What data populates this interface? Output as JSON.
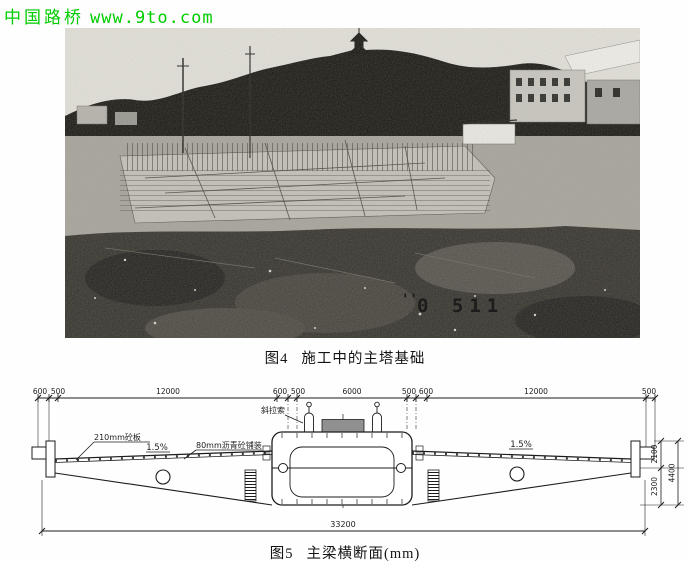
{
  "header": {
    "site_name": "中国路桥",
    "url": "www.9to.com",
    "color": "#00cc00"
  },
  "photo": {
    "description": "construction-site-photo",
    "stamp_marks": "''",
    "stamp": "0 511"
  },
  "figure4": {
    "label": "图4",
    "title": "施工中的主塔基础"
  },
  "figure5": {
    "label": "图5",
    "title": "主梁横断面(mm)",
    "ink": "#1c1c1c",
    "dimensions": {
      "top": [
        "600",
        "500",
        "12000",
        "600",
        "500",
        "6000",
        "500",
        "600",
        "12000",
        "500"
      ],
      "bottom_total": "33200",
      "right_upper": "2100",
      "right_lower": "2300",
      "right_total": "4400"
    },
    "annotations": {
      "deck_slab": "210mm砼板",
      "slope_left": "1.5%",
      "pavement": "80mm沥青砼铺装",
      "stay_cable": "斜拉索",
      "slope_right": "1.5%"
    }
  }
}
